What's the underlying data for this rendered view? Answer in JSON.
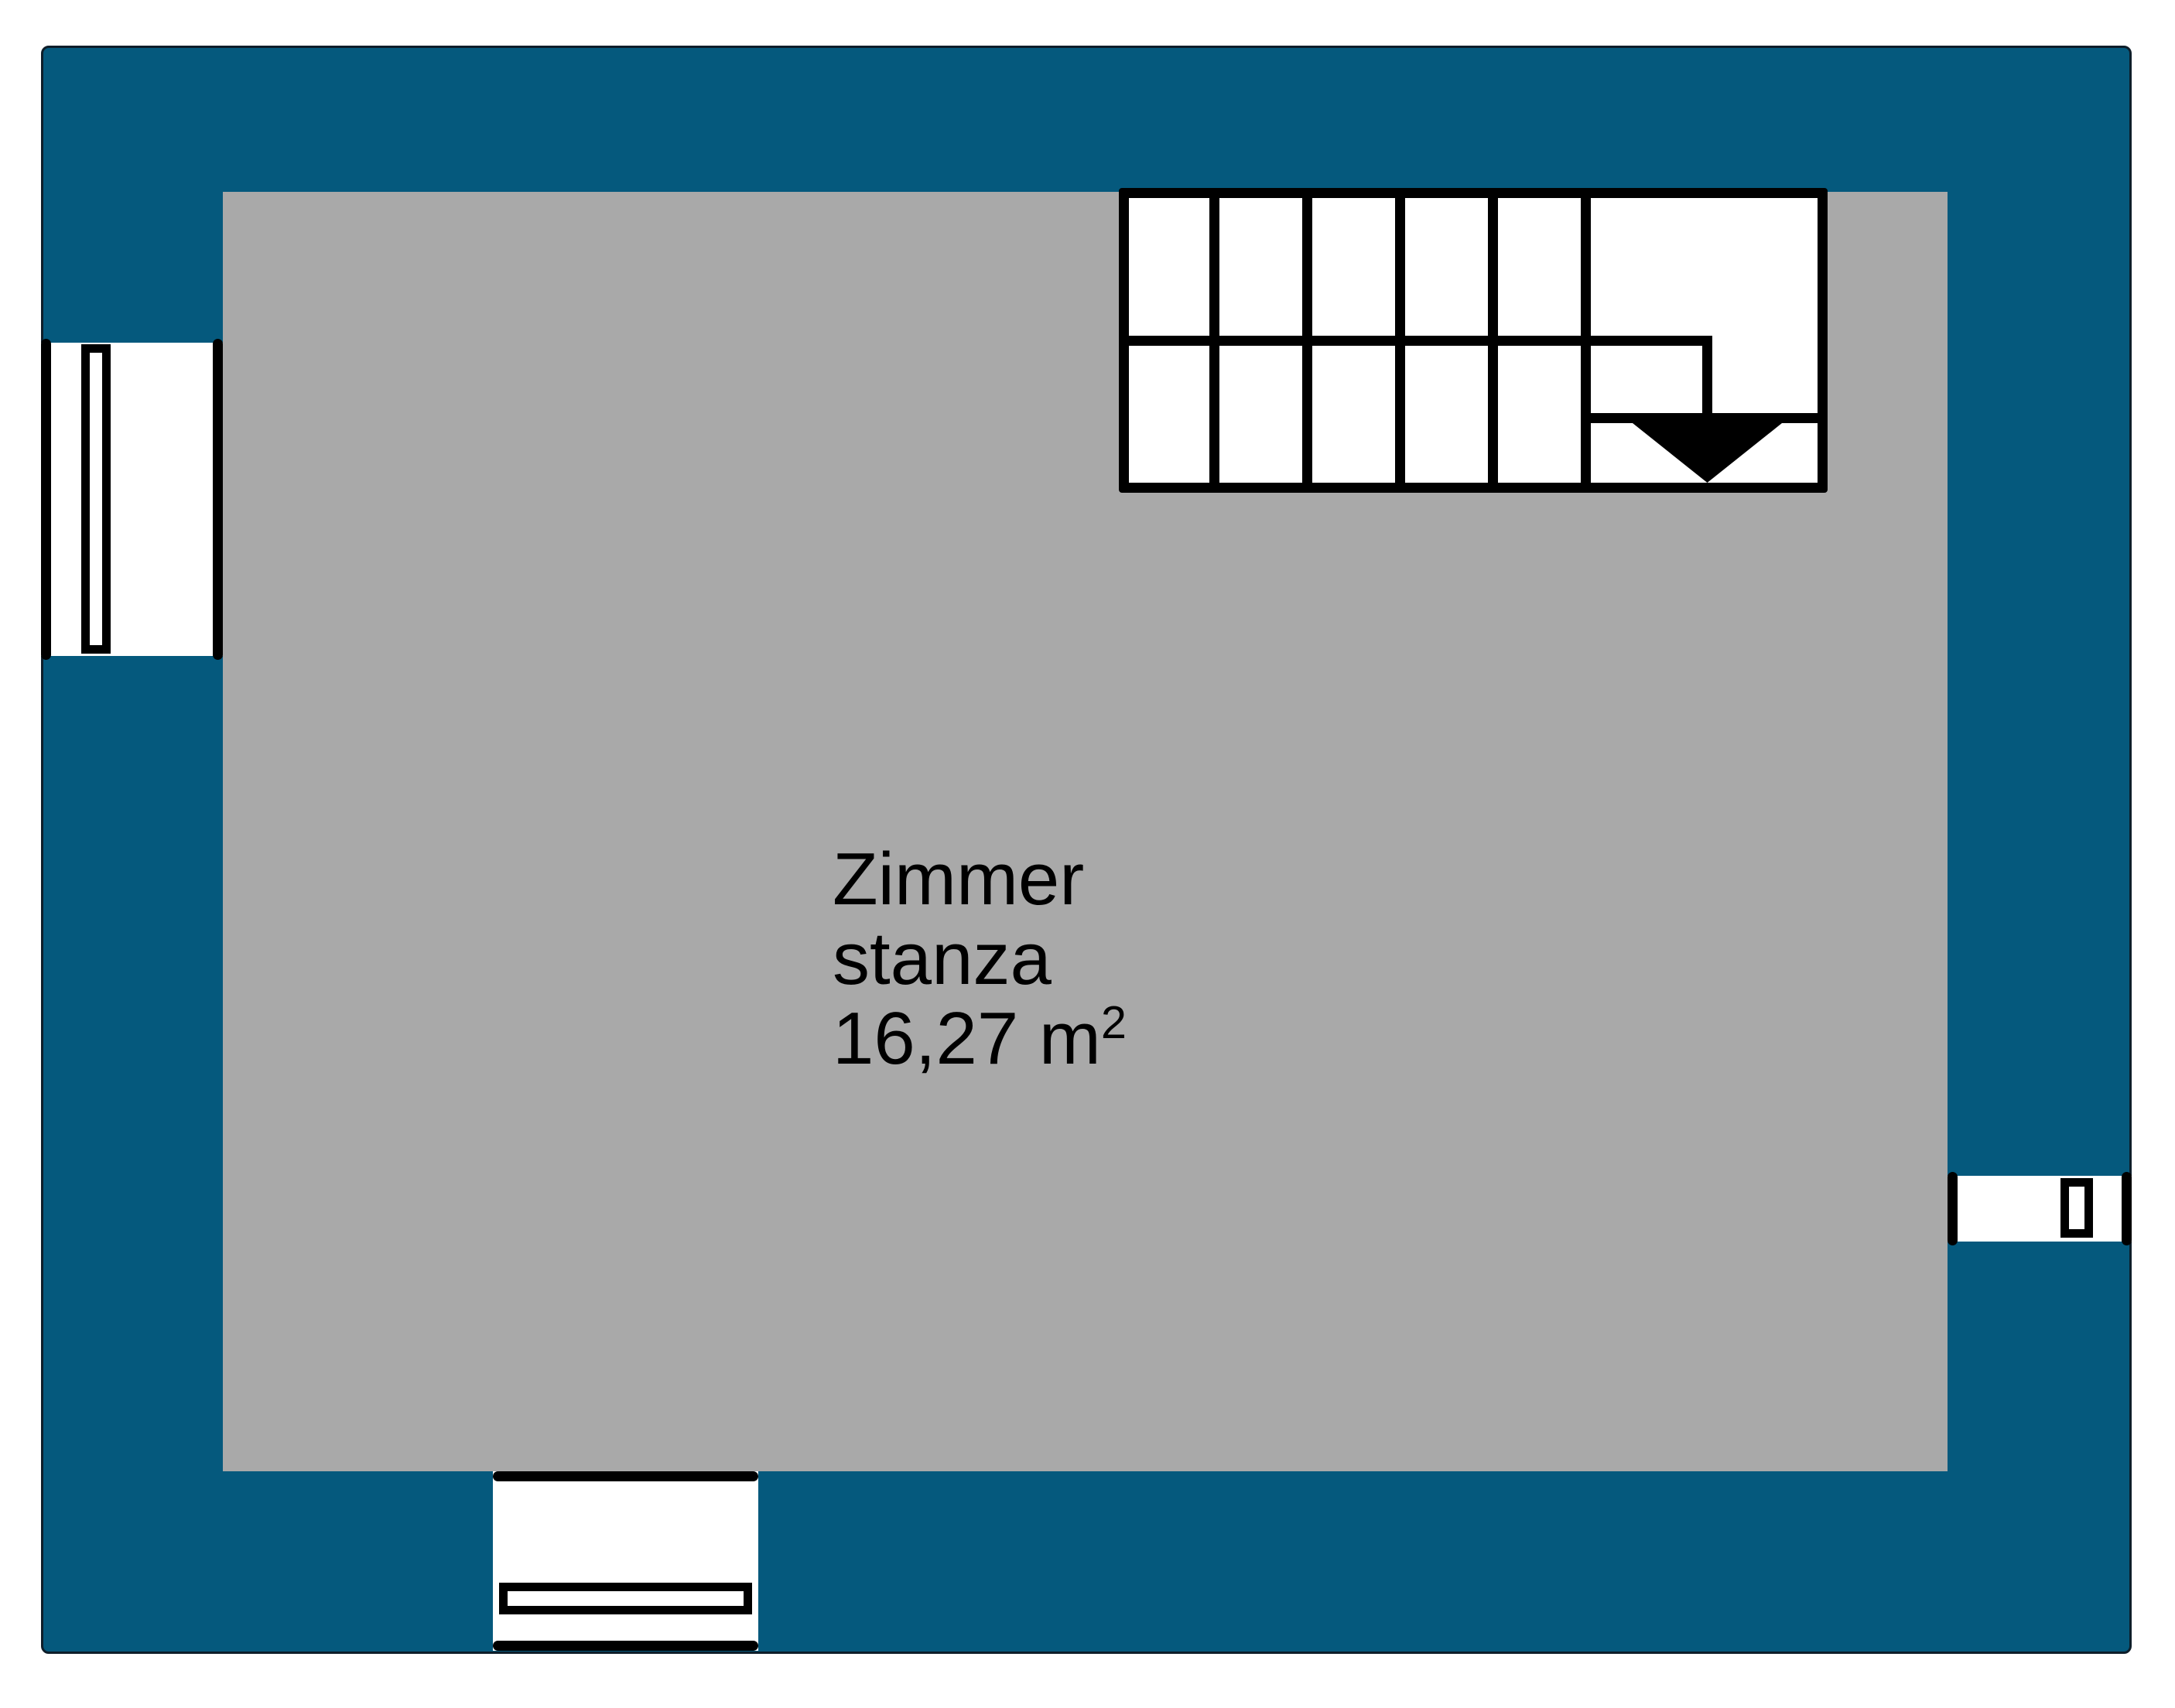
{
  "document": {
    "type": "floor-plan"
  },
  "room": {
    "name_de": "Zimmer",
    "name_it": "stanza",
    "area_value": "16,27 m",
    "area_exponent": "2"
  },
  "colors": {
    "wall": "#05597d",
    "floor": "#a9a9a9",
    "line": "#000000",
    "outline": "#0e1e2a",
    "background": "#ffffff"
  }
}
